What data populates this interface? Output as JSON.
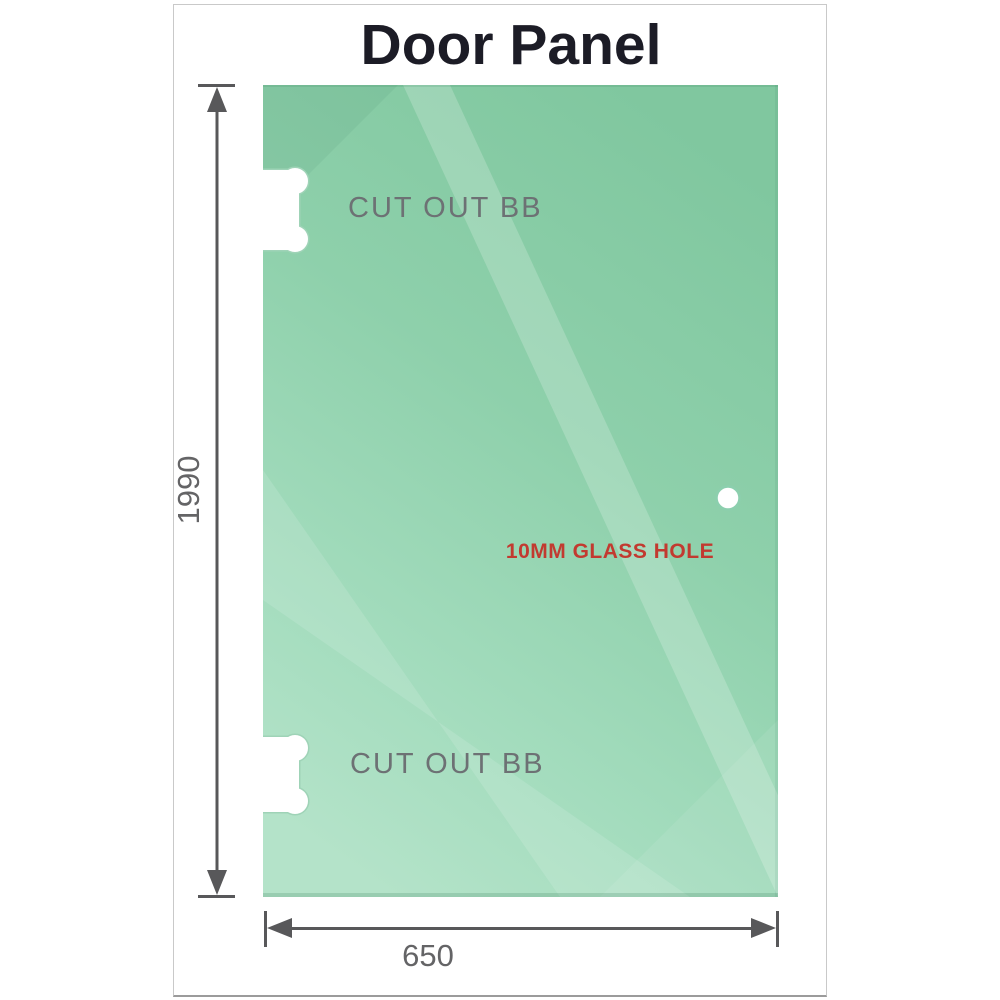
{
  "title": "Door Panel",
  "panel": {
    "cutout_top": {
      "label": "CUT OUT BB"
    },
    "cutout_bottom": {
      "label": "CUT OUT BB"
    },
    "hole": {
      "label": "10MM GLASS HOLE"
    }
  },
  "dimensions": {
    "height": {
      "label": "1990"
    },
    "width": {
      "label": "650"
    }
  },
  "colors": {
    "glass_dark": "#80c79f",
    "glass_mid": "#8ed0ab",
    "glass_light": "#b4e3c9",
    "cutout_outline": "#9fd3b7",
    "hole_ring": "#8ccfae",
    "dimension_gray": "#58585a",
    "hole_label_red": "#c23a30",
    "cutout_label_gray": "#6d7174",
    "title_dark": "#1c1c26",
    "frame_border": "#c9c9c9"
  }
}
